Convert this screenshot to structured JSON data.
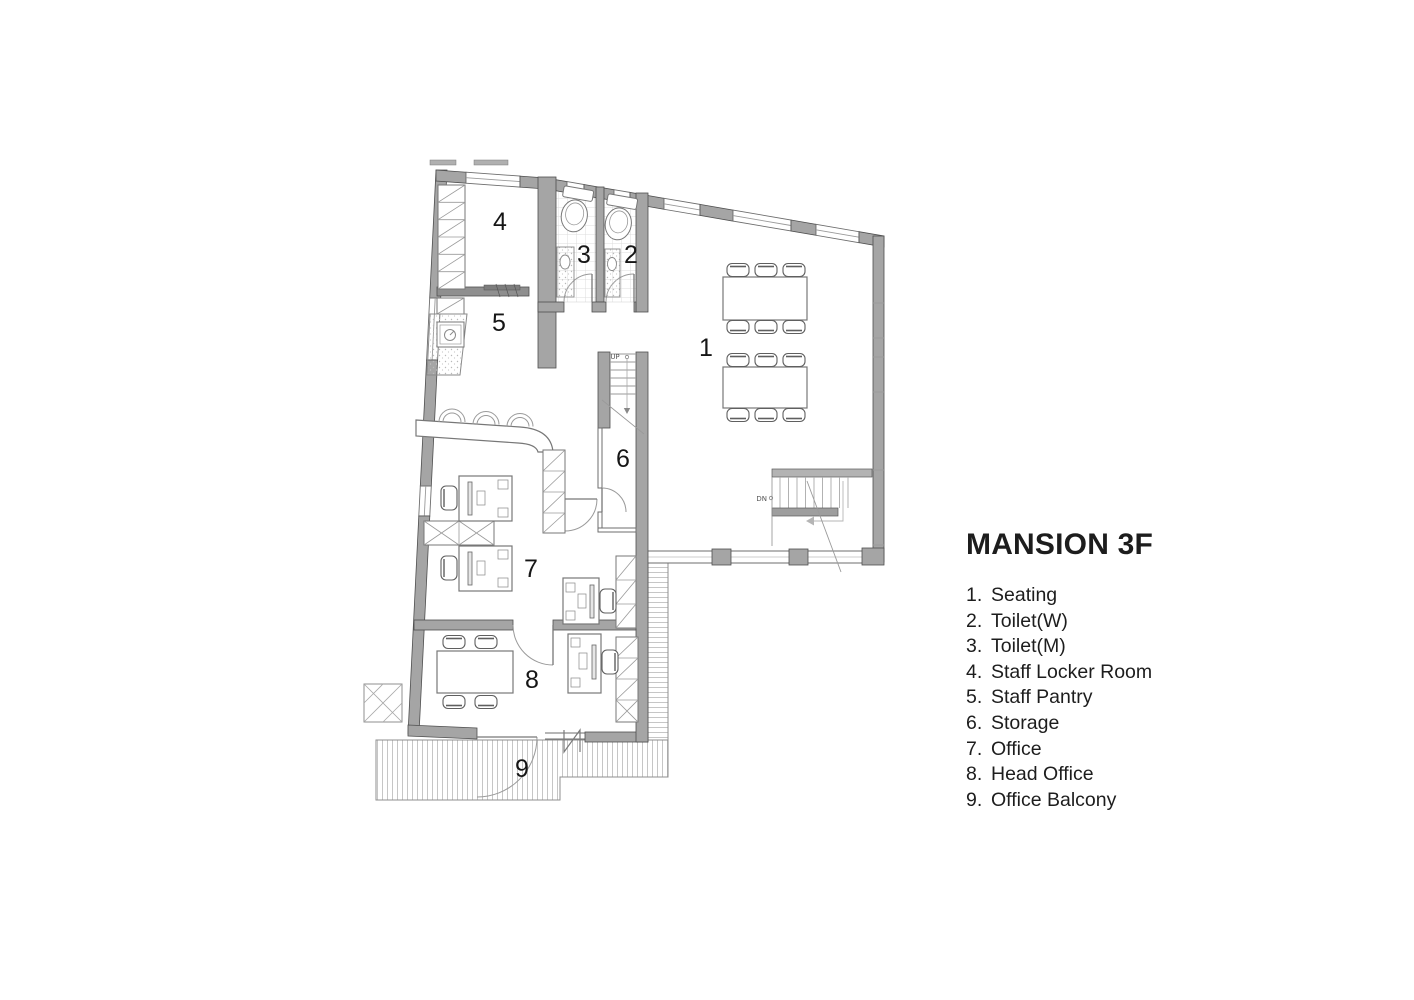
{
  "title": "MANSION 3F",
  "rooms": [
    {
      "n": "1",
      "legend_n": "1.",
      "label": "Seating"
    },
    {
      "n": "2",
      "legend_n": "2.",
      "label": "Toilet(W)"
    },
    {
      "n": "3",
      "legend_n": "3.",
      "label": "Toilet(M)"
    },
    {
      "n": "4",
      "legend_n": "4.",
      "label": "Staff Locker Room"
    },
    {
      "n": "5",
      "legend_n": "5.",
      "label": "Staff Pantry"
    },
    {
      "n": "6",
      "legend_n": "6.",
      "label": "Storage"
    },
    {
      "n": "7",
      "legend_n": "7.",
      "label": "Office"
    },
    {
      "n": "8",
      "legend_n": "8.",
      "label": "Head Office"
    },
    {
      "n": "9",
      "legend_n": "9.",
      "label": "Office Balcony"
    }
  ],
  "plan": {
    "stair_up": "UP",
    "stair_dn": "DN"
  },
  "colors": {
    "wall": "#a5a5a5",
    "wall_outline": "#4f4f4f",
    "text": "#1d1d1d",
    "background": "#ffffff"
  }
}
